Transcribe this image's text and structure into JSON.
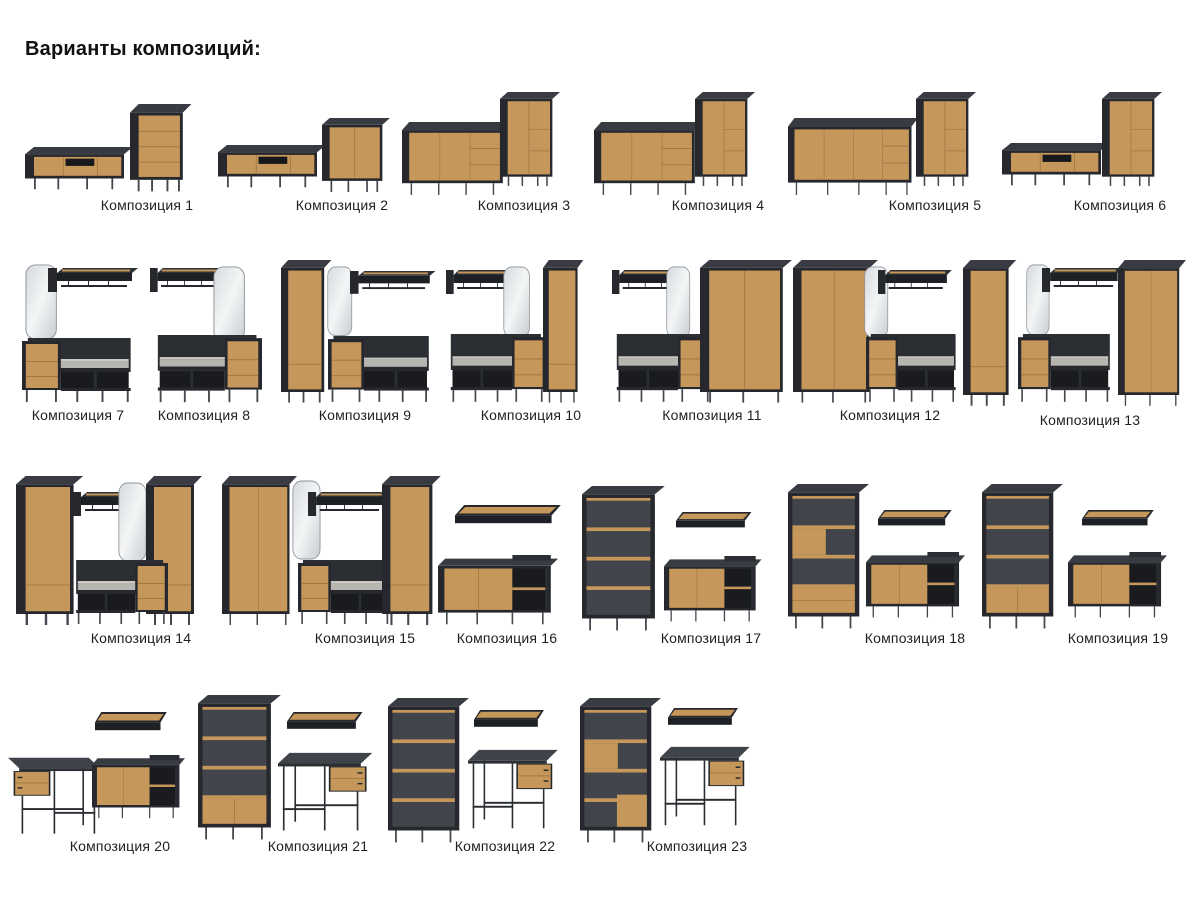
{
  "page": {
    "title": "Варианты композиций:"
  },
  "palette": {
    "wood": "#c5975a",
    "wood_seam": "#a07a45",
    "carcass_black": "#26282d",
    "top_face": "#383c42",
    "interior_gray": "#41454b",
    "cushion_gray": "#b7b5b0",
    "mirror_light": "#f3f5f6",
    "desk_top_gray": "#3f444a",
    "label_text": "#1f1f1f",
    "background": "#ffffff"
  },
  "compositions": [
    {
      "id": 1,
      "label": "Композиция 1",
      "items": [
        "tv-stand",
        "chest-of-drawers"
      ]
    },
    {
      "id": 2,
      "label": "Композиция 2",
      "items": [
        "tv-stand",
        "cabinet"
      ]
    },
    {
      "id": 3,
      "label": "Композиция 3",
      "items": [
        "sideboard",
        "tall-cabinet"
      ]
    },
    {
      "id": 4,
      "label": "Композиция 4",
      "items": [
        "sideboard",
        "tall-cabinet"
      ]
    },
    {
      "id": 5,
      "label": "Композиция 5",
      "items": [
        "long-sideboard",
        "tall-cabinet"
      ]
    },
    {
      "id": 6,
      "label": "Композиция 6",
      "items": [
        "tv-stand",
        "tall-cabinet"
      ]
    },
    {
      "id": 7,
      "label": "Композиция 7",
      "items": [
        "mirror",
        "coat-rack",
        "hallway-bench"
      ]
    },
    {
      "id": 8,
      "label": "Композиция 8",
      "items": [
        "coat-rack",
        "mirror",
        "hallway-bench"
      ]
    },
    {
      "id": 9,
      "label": "Композиция 9",
      "items": [
        "tall-wardrobe",
        "mirror",
        "coat-rack",
        "hallway-bench"
      ]
    },
    {
      "id": 10,
      "label": "Композиция 10",
      "items": [
        "coat-rack",
        "mirror",
        "hallway-bench",
        "tall-wardrobe"
      ]
    },
    {
      "id": 11,
      "label": "Композиция 11",
      "items": [
        "coat-rack",
        "mirror",
        "hallway-bench",
        "wardrobe"
      ]
    },
    {
      "id": 12,
      "label": "Композиция 12",
      "items": [
        "wardrobe",
        "mirror",
        "coat-rack",
        "hallway-bench"
      ]
    },
    {
      "id": 13,
      "label": "Композиция 13",
      "items": [
        "tall-wardrobe",
        "mirror",
        "coat-rack",
        "hallway-bench",
        "wardrobe"
      ]
    },
    {
      "id": 14,
      "label": "Композиция 14",
      "items": [
        "tall-wardrobe",
        "coat-rack",
        "mirror",
        "tall-wardrobe",
        "hallway-bench"
      ]
    },
    {
      "id": 15,
      "label": "Композиция 15",
      "items": [
        "wardrobe",
        "mirror",
        "coat-rack",
        "hallway-bench",
        "tall-wardrobe"
      ]
    },
    {
      "id": 16,
      "label": "Композиция 16",
      "items": [
        "wall-shelf",
        "sideboard"
      ]
    },
    {
      "id": 17,
      "label": "Композиция 17",
      "items": [
        "bookcase",
        "wall-shelf",
        "sideboard"
      ]
    },
    {
      "id": 18,
      "label": "Композиция 18",
      "items": [
        "bookcase",
        "wall-shelf",
        "sideboard"
      ]
    },
    {
      "id": 19,
      "label": "Композиция 19",
      "items": [
        "bookcase",
        "wall-shelf",
        "sideboard"
      ]
    },
    {
      "id": 20,
      "label": "Композиция 20",
      "items": [
        "wall-shelf",
        "desk",
        "sideboard"
      ]
    },
    {
      "id": 21,
      "label": "Композиция 21",
      "items": [
        "bookcase",
        "wall-shelf",
        "desk"
      ]
    },
    {
      "id": 22,
      "label": "Композиция 22",
      "items": [
        "bookcase",
        "wall-shelf",
        "desk"
      ]
    },
    {
      "id": 23,
      "label": "Композиция 23",
      "items": [
        "bookcase",
        "wall-shelf",
        "desk"
      ]
    }
  ]
}
